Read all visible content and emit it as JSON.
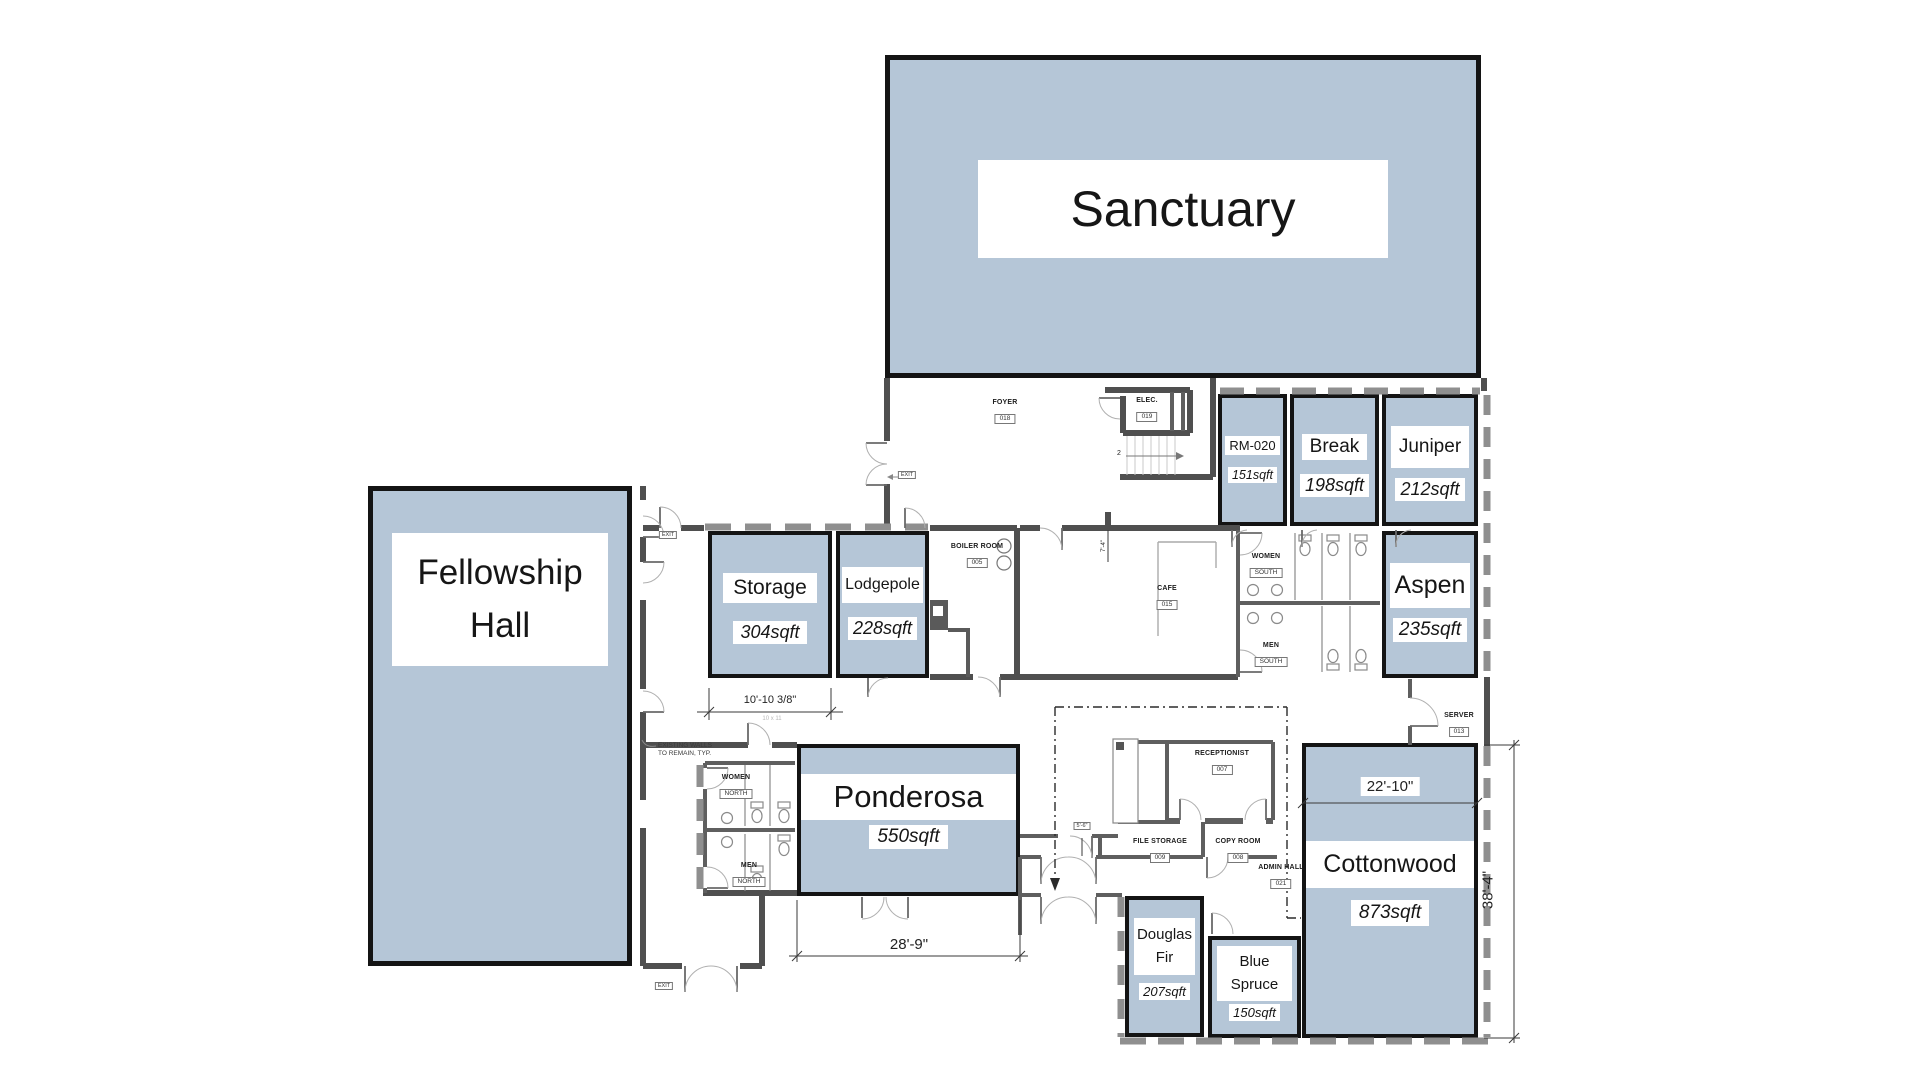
{
  "palette": {
    "room_fill": "#b5c6d7",
    "room_border": "#141414",
    "wall": "#4f4f4f",
    "window_wall": "#8f8f8f",
    "text": "#1a1a1a"
  },
  "rooms": [
    {
      "name": "Sanctuary"
    },
    {
      "name": "Fellowship Hall"
    },
    {
      "name": "Storage",
      "sqft": "304sqft"
    },
    {
      "name": "Lodgepole",
      "sqft": "228sqft"
    },
    {
      "name": "Ponderosa",
      "sqft": "550sqft"
    },
    {
      "name": "RM-020",
      "sqft": "151sqft"
    },
    {
      "name": "Break",
      "sqft": "198sqft"
    },
    {
      "name": "Juniper",
      "sqft": "212sqft"
    },
    {
      "name": "Aspen",
      "sqft": "235sqft"
    },
    {
      "name": "Cottonwood",
      "sqft": "873sqft"
    },
    {
      "name": "Douglas Fir",
      "sqft": "207sqft"
    },
    {
      "name": "Blue Spruce",
      "sqft": "150sqft"
    }
  ],
  "small_rooms": [
    {
      "name": "FOYER",
      "tag": "018"
    },
    {
      "name": "ELEC.",
      "tag": "019"
    },
    {
      "name": "BOILER ROOM",
      "tag": "005"
    },
    {
      "name": "CAFE",
      "tag": "015"
    },
    {
      "name": "WOMEN",
      "tag": "SOUTH"
    },
    {
      "name": "MEN",
      "tag": "SOUTH"
    },
    {
      "name": "WOMEN",
      "tag": "NORTH"
    },
    {
      "name": "MEN",
      "tag": "NORTH"
    },
    {
      "name": "RECEPTIONIST",
      "tag": "007"
    },
    {
      "name": "FILE STORAGE",
      "tag": "009"
    },
    {
      "name": "COPY ROOM",
      "tag": "008"
    },
    {
      "name": "ADMIN HALL",
      "tag": "021"
    },
    {
      "name": "SERVER",
      "tag": "013"
    }
  ],
  "dimensions": {
    "storage_width": "10'-10 3/8\"",
    "storage_width_sub": "10 x 11",
    "ponderosa_width": "28'-9\"",
    "cottonwood_width": "22'-10\"",
    "cottonwood_height": "38'-4\"",
    "hall_width": "5'-6\"",
    "cafe_width": "7'-4\""
  },
  "annotations": {
    "existing_walls_line1": "EXISTING WALLS",
    "existing_walls_line2": "TO REMAIN, TYP.",
    "stair_number": "2",
    "exit_tag": "EXIT"
  }
}
